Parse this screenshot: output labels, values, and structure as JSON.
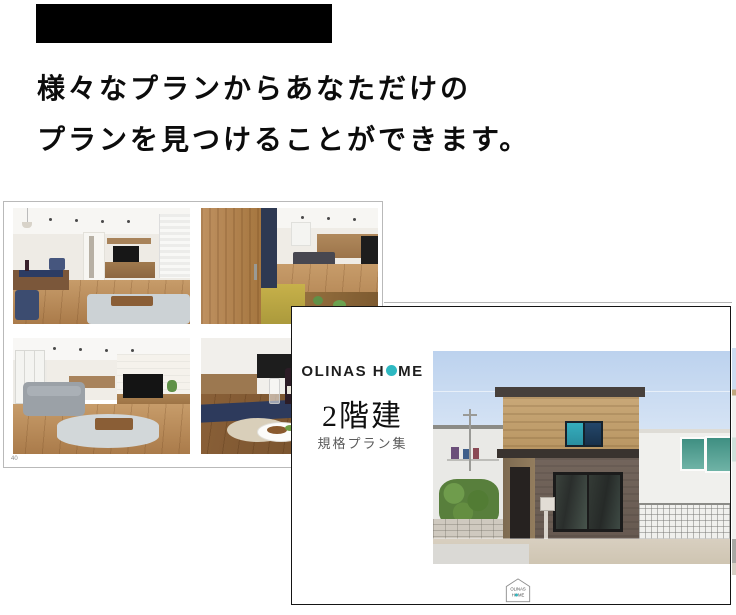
{
  "section": {
    "title_bar_color": "#000000",
    "heading_line1": "様々なプランからあなただけの",
    "heading_line2": "プランを見つけることができます。"
  },
  "interior_page": {
    "page_number": "40"
  },
  "cover_page": {
    "brand_pre": "OLINAS H",
    "brand_post": "ME",
    "brand_dot_color": "#2fb9c2",
    "title": "2階建",
    "subtitle": "規格プラン集",
    "seal_line1": "OLINAS",
    "seal_line2": "HOME"
  }
}
